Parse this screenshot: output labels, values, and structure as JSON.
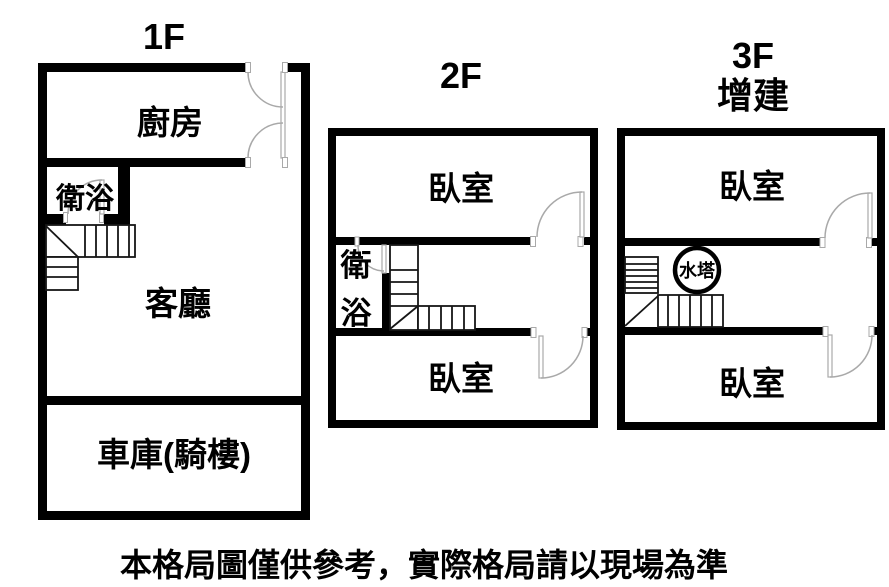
{
  "colors": {
    "background": "#ffffff",
    "wall": "#000000",
    "door_line": "#a9a9a9",
    "stair_line": "#161616",
    "text": "#000000"
  },
  "floors": [
    {
      "id": "1f",
      "title": "1F",
      "rooms": {
        "kitchen": "廚房",
        "bathroom": "衛浴",
        "living": "客廳",
        "garage": "車庫(騎樓)"
      }
    },
    {
      "id": "2f",
      "title": "2F",
      "rooms": {
        "bedroom_top": "臥室",
        "bath_char_top": "衛",
        "bath_char_bottom": "浴",
        "bedroom_bottom": "臥室"
      }
    },
    {
      "id": "3f",
      "title": "3F",
      "subtitle": "增建",
      "rooms": {
        "bedroom_top": "臥室",
        "water_tank": "水塔",
        "bedroom_bottom": "臥室"
      }
    }
  ],
  "disclaimer": "本格局圖僅供參考，實際格局請以現場為準"
}
